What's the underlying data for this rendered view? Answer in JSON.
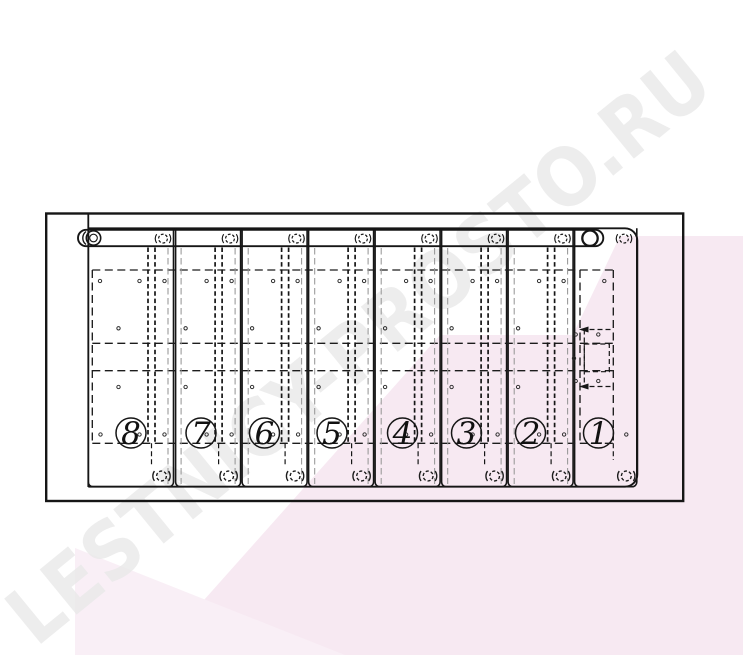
{
  "watermark": {
    "text": "LESTNICY-PROSTO.RU"
  },
  "panels": [
    {
      "label": "8"
    },
    {
      "label": "7"
    },
    {
      "label": "6"
    },
    {
      "label": "5"
    },
    {
      "label": "4"
    },
    {
      "label": "3"
    },
    {
      "label": "2"
    },
    {
      "label": "1"
    }
  ],
  "colors": {
    "background": "#ffffff",
    "line": "#161616",
    "accent_pink": "#f7e9f2",
    "accent_pink_light": "#f9eff6",
    "watermark_gray": "#e9e9e9"
  }
}
